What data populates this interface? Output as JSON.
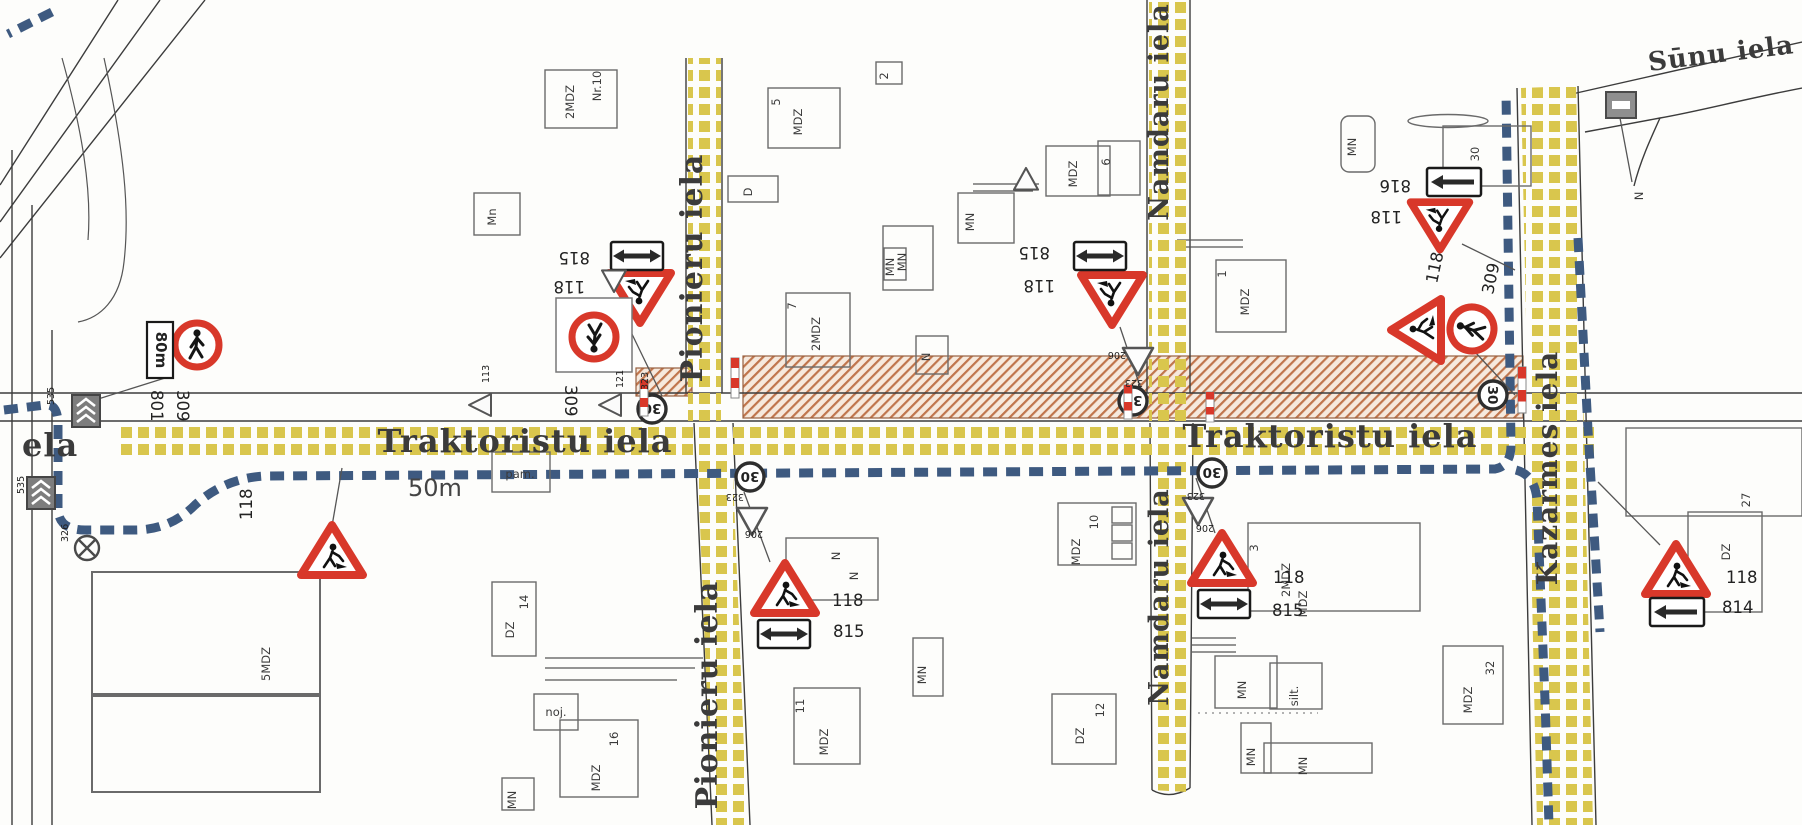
{
  "map": {
    "streets": {
      "traktoristu": "Traktoristu iela",
      "pionieru": "Pionieru iela",
      "namdaru": "Namdaru iela",
      "kazarmes": "Kazarmes iela",
      "sunu": "Sūnu iela",
      "left_street_partial": "ela"
    },
    "annotations": {
      "detour_distance": "50m"
    },
    "signs": {
      "road_works": "118",
      "no_pedestrians": "309",
      "speed_30": "30",
      "speed_limit_code": "323",
      "give_way_code": "206",
      "extent_both_code": "815",
      "extent_left_code": "814",
      "extent_right_code": "816",
      "distance_plate_code": "801",
      "distance_80m": "80m",
      "lane_sign_code": "535",
      "closure_code": "326",
      "code_113": "113",
      "code_121": "121"
    },
    "buildings": {
      "mdz": "MDZ",
      "mn": "MN",
      "mn_small": "Mn",
      "dz": "DZ",
      "n": "N",
      "d": "D",
      "mdz2": "2MDZ",
      "mdz5": "5MDZ",
      "nr10": "Nr.10",
      "pam": "pam.",
      "noj": "noj.",
      "silt": "silt.",
      "no1": "1",
      "no2": "2",
      "no3": "3",
      "no5": "5",
      "no6": "6",
      "no7": "7",
      "no10": "10",
      "no11": "11",
      "no12": "12",
      "no14": "14",
      "no16": "16",
      "no27": "27",
      "no30": "30",
      "no32": "32"
    }
  }
}
